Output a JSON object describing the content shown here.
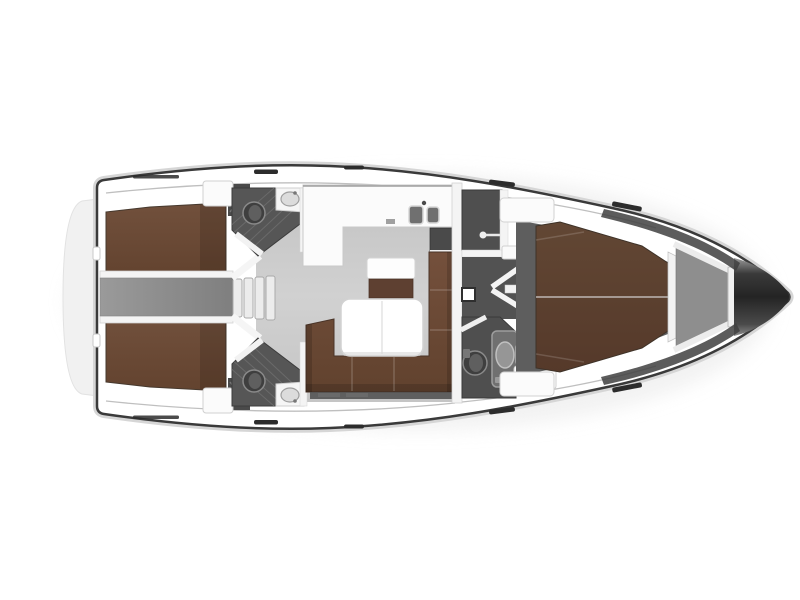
{
  "plan": {
    "kind": "yacht-interior-floor-plan",
    "orientation": "bow-right",
    "visible_text": ""
  },
  "colors": {
    "background": "#ffffff",
    "hull_fill": "#ffffff",
    "hull_outline": "#3a3a3a",
    "gunwale": "#d6d6d6",
    "deck_line": "#bfbfbf",
    "swim_platform": "#f1f1f1",
    "shadow": "#e7e7e7",
    "wall_white": "#f4f4f4",
    "salon_floor_a": "#c3c3c3",
    "salon_floor_b": "#d1d1d1",
    "corridor_floor_a": "#9a9a9a",
    "corridor_floor_b": "#7f7f7f",
    "head_room_aft": "#565656",
    "head_room_fwd": "#4f4f4f",
    "fwd_cabin_floor": "#5e5e5e",
    "berth_aft_a": "#71503c",
    "berth_aft_b": "#63432f",
    "berth_fwd_a": "#624734",
    "berth_fwd_b": "#55392a",
    "sofa_a": "#74503c",
    "sofa_b": "#61422e",
    "seat_front": "#5e4031",
    "furniture_white": "#fbfbfb",
    "fixture_dark": "#3f3f3f",
    "fixture_mid": "#707070",
    "chart_cabinet": "#4a4a4a",
    "anchor_locker": "#8e8e8e",
    "bow_band": "#3f3f3f",
    "nose_light": "#9a9a9a",
    "nose_dark": "#242424",
    "hatch_mark": "#2c2c2c"
  }
}
